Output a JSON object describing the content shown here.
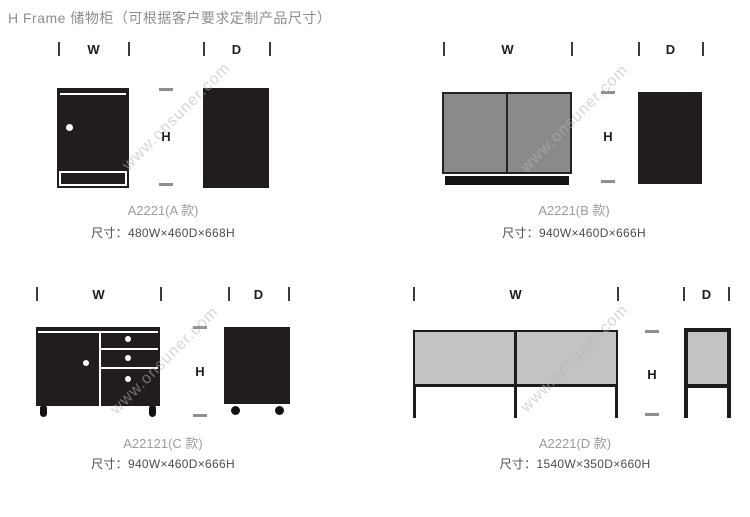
{
  "page": {
    "title": "H Frame  储物柜（可根据客户要求定制产品尺寸）",
    "watermark": "www.onsuner.com"
  },
  "dims": {
    "w": "W",
    "d": "D",
    "h": "H"
  },
  "products": [
    {
      "model": "A2221(A 款)",
      "size": "尺寸：480W×460D×668H"
    },
    {
      "model": "A2221(B 款)",
      "size": "尺寸：940W×460D×666H"
    },
    {
      "model": "A22121(C 款)",
      "size": "尺寸：940W×460D×666H"
    },
    {
      "model": "A2221(D 款)",
      "size": "尺寸：1540W×350D×660H"
    }
  ],
  "colors": {
    "cabinet_black": "#211d1e",
    "door_gray": "#8a8a8a",
    "panel_light_gray": "#c3c3c5",
    "text_gray": "#9c9c9c",
    "spec_text": "#4c4c4c",
    "watermark_gray": "#b6b4b0"
  }
}
